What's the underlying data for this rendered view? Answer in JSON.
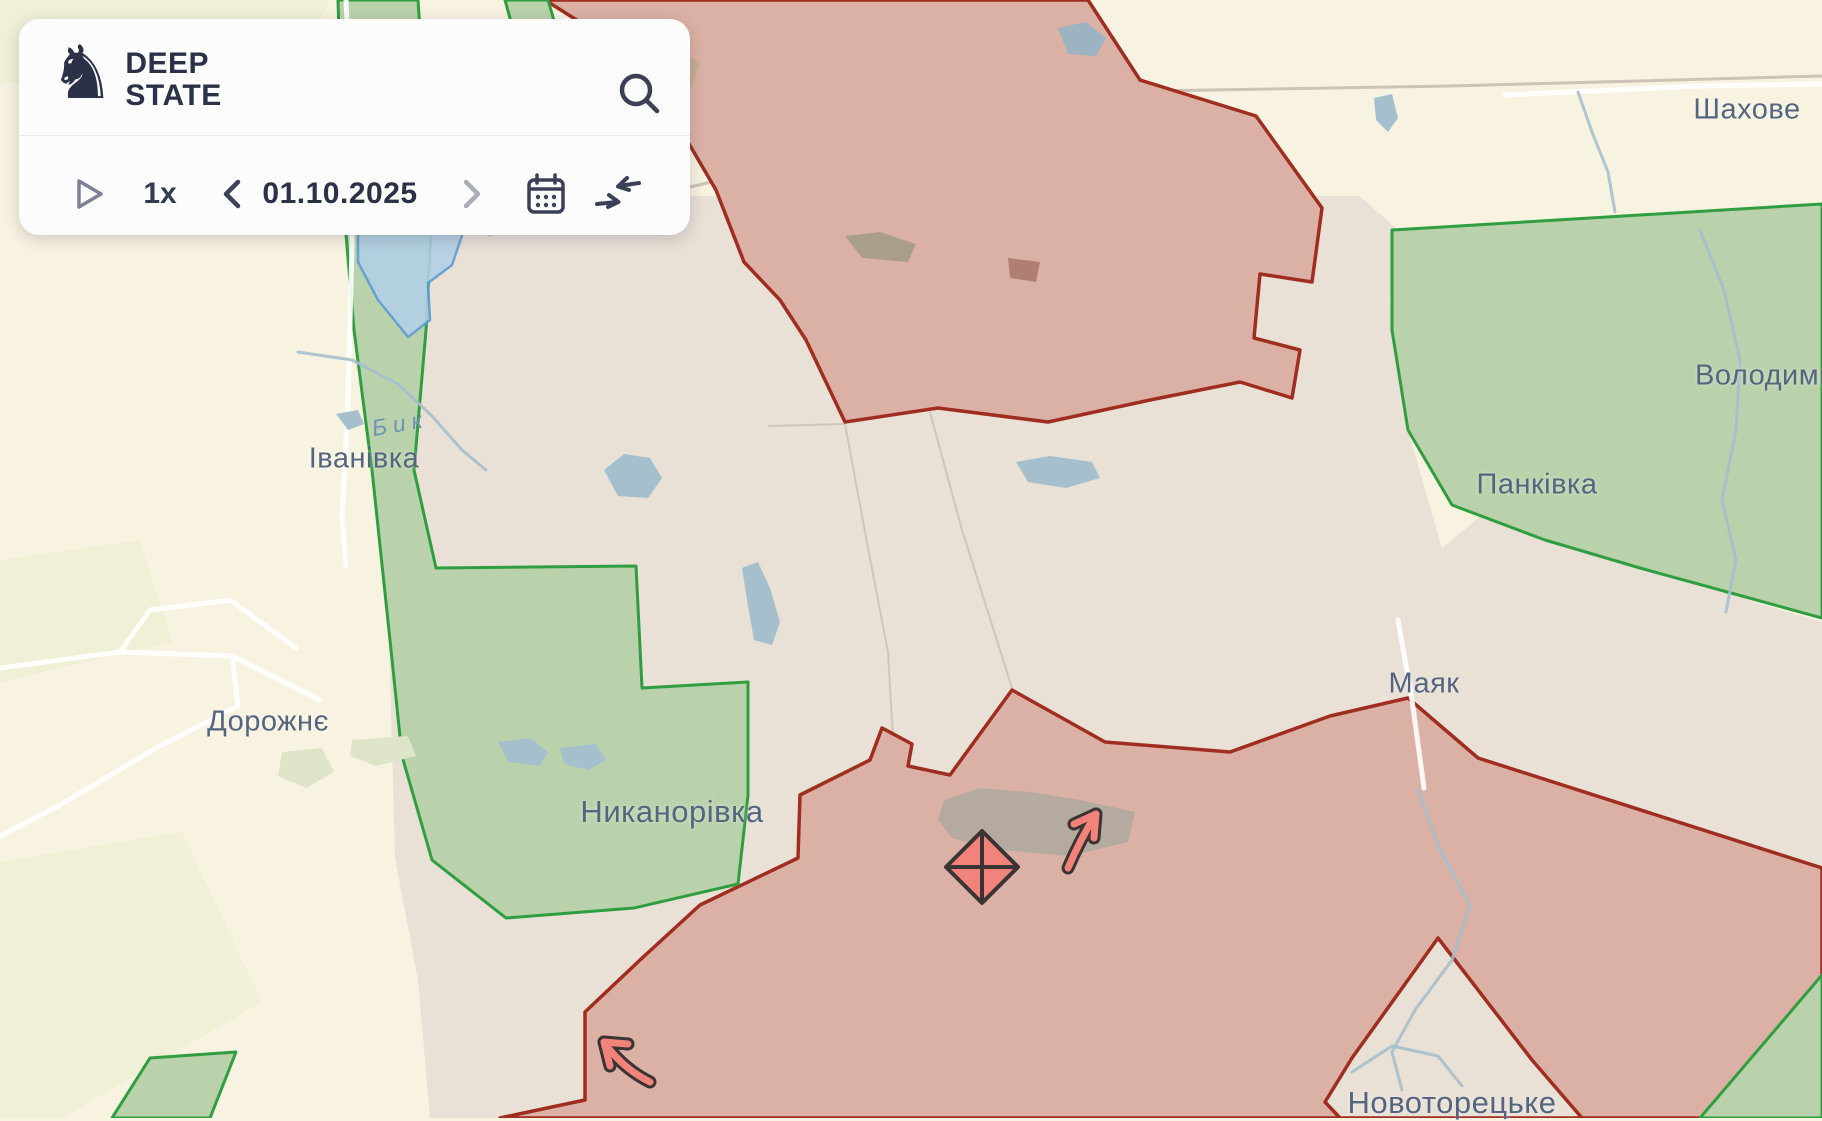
{
  "panel": {
    "brand": {
      "line1": "DEEP",
      "line2": "STATE"
    },
    "controls": {
      "speed": "1x",
      "date": "01.10.2025"
    }
  },
  "map": {
    "labels": {
      "towns": [
        {
          "name": "Іванівка"
        },
        {
          "name": "Дорожнє"
        },
        {
          "name": "Никанорівка"
        },
        {
          "name": "Шахове"
        },
        {
          "name": "Володими"
        },
        {
          "name": "Панківка"
        },
        {
          "name": "Маяк"
        },
        {
          "name": "Новоторецьке"
        }
      ],
      "river": {
        "name": "Бик"
      }
    },
    "symbols": [
      {
        "type": "fortification-diamond",
        "x": 982,
        "y": 867
      },
      {
        "type": "attack-arrow-northeast",
        "x": 1090,
        "y": 833
      },
      {
        "type": "attack-arrow-northwest",
        "x": 625,
        "y": 1062
      }
    ],
    "colors": {
      "base_fill": "#f8f3e1",
      "gray_zone_fill": "#e9e0d6",
      "territory_occupied_fill": "#dcb1a5",
      "territory_occupied_border": "#9f2d20",
      "territory_liberated_fill": "#bad2ab",
      "territory_liberated_border": "#2f9e41",
      "territory_contested_fill": "#b3d0e8",
      "territory_contested_border": "#5b9bd5",
      "water": "#a5bfcd",
      "label_town": "#54657f",
      "label_river": "#6e94b4",
      "symbol_red": "#f2837b",
      "symbol_outline": "#3a3434",
      "panel_icon": "#3b4056"
    }
  }
}
